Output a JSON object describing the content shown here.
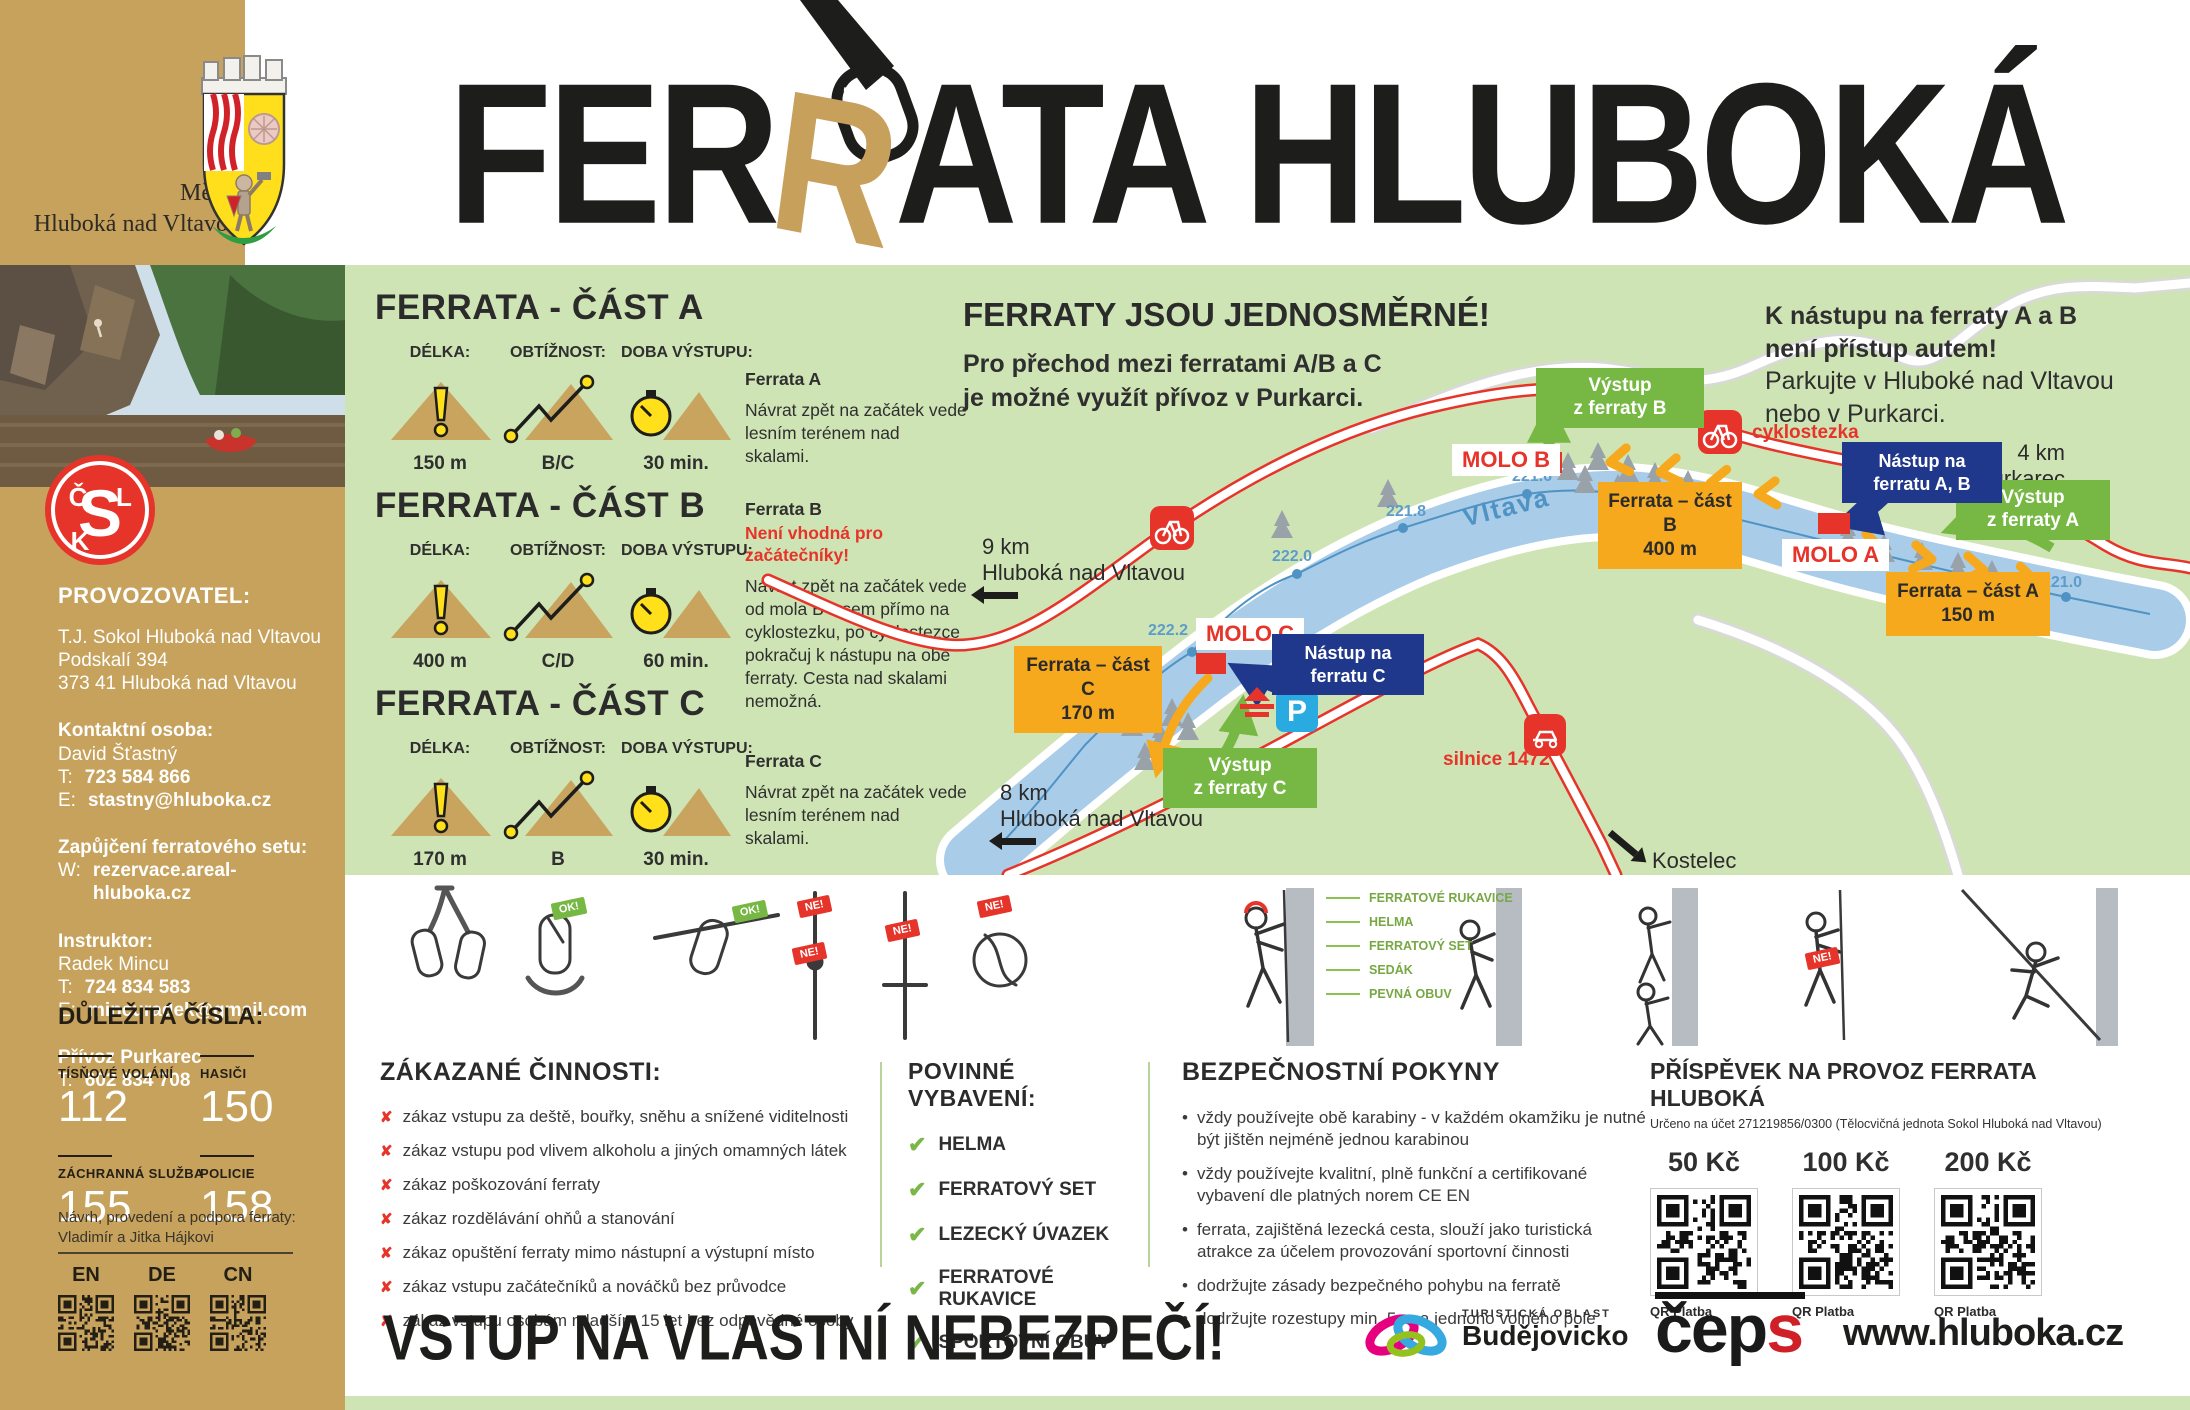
{
  "header": {
    "title_pre": "FER",
    "title_r": "R",
    "title_post": "ATA HLUBOKÁ"
  },
  "sidebar": {
    "city_line1": "Město",
    "city_line2": "Hluboká nad Vltavou",
    "provider_heading": "PROVOZOVATEL:",
    "provider_lines": [
      "T.J. Sokol Hluboká nad Vltavou",
      "Podskalí 394",
      "373 41 Hluboká nad Vltavou"
    ],
    "contact_heading": "Kontaktní osoba:",
    "contact_name": "David Šťastný",
    "phone_label": "T:",
    "email_label": "E:",
    "web_label": "W:",
    "contact_phone": "723 584 866",
    "contact_email": "stastny@hluboka.cz",
    "rental_heading": "Zapůjčení ferratového setu:",
    "rental_web": "rezervace.areal-hluboka.cz",
    "instructor_heading": "Instruktor:",
    "instructor_name": "Radek Mincu",
    "instructor_phone": "724 834 583",
    "instructor_email": "mincuradek@gmail.com",
    "ferry_heading": "Přívoz Purkarec",
    "ferry_phone": "602 834 708",
    "emergency_heading": "DŮLEŽITÁ ČÍSLA:",
    "emergency": [
      {
        "label": "TÍSŇOVÉ VOLÁNÍ",
        "number": "112"
      },
      {
        "label": "HASIČI",
        "number": "150"
      },
      {
        "label": "ZÁCHRANNÁ SLUŽBA",
        "number": "155"
      },
      {
        "label": "POLICIE",
        "number": "158"
      }
    ],
    "credits_line1": "Návrh, provedení a podpora ferraty:",
    "credits_line2": "Vladimír a Jitka Hájkovi",
    "languages": [
      "EN",
      "DE",
      "CN"
    ]
  },
  "routes": {
    "length_label": "DÉLKA:",
    "difficulty_label": "OBTÍŽNOST:",
    "time_label": "DOBA VÝSTUPU:",
    "sections": [
      {
        "title": "FERRATA - ČÁST A",
        "length": "150 m",
        "difficulty": "B/C",
        "time": "30 min.",
        "desc_title": "Ferrata A",
        "desc": "Návrat zpět na začátek vede lesním terénem nad skalami."
      },
      {
        "title": "FERRATA - ČÁST B",
        "length": "400 m",
        "difficulty": "C/D",
        "time": "60 min.",
        "desc_title": "Ferrata B",
        "warning": "Není vhodná pro začátečníky!",
        "desc": "Návrat zpět na začátek vede od mola B lesem přímo na cyklostezku, po cyklostezce pokračuj k nástupu na obě ferraty. Cesta nad skalami nemožná."
      },
      {
        "title": "FERRATA - ČÁST C",
        "length": "170 m",
        "difficulty": "B",
        "time": "30 min.",
        "desc_title": "Ferrata C",
        "desc": "Návrat zpět na začátek vede lesním terénem nad skalami."
      }
    ]
  },
  "map": {
    "heading": "FERRATY JSOU JEDNOSMĚRNÉ!",
    "sub1": "Pro přechod mezi ferratami  A/B a C",
    "sub2": "je možné využít přívoz v Purkarci.",
    "note1": "K nástupu na ferraty A a B",
    "note2": "není přístup autem!",
    "note3": "Parkujte v Hluboké nad Vltavou",
    "note4": "nebo v Purkarci.",
    "dir_purkarec_distance": "4 km",
    "dir_purkarec_place": "Purkarec",
    "dir_hluboka9_distance": "9 km",
    "dir_hluboka9_place": "Hluboká nad Vltavou",
    "dir_hluboka8_distance": "8 km",
    "dir_hluboka8_place": "Hluboká nad Vltavou",
    "dir_kostelec": "Kostelec",
    "river_name": "Vltava",
    "parking": "P",
    "cyklostezka": "cyklostezka",
    "silnice": "silnice 1472",
    "contours": [
      "221.6",
      "221.8",
      "222.0",
      "222.2",
      "222.4",
      "221.0"
    ],
    "labels": {
      "molo_a": "MOLO A",
      "molo_b": "MOLO B",
      "molo_c": "MOLO C",
      "vystup_a_l1": "Výstup",
      "vystup_a_l2": "z ferraty A",
      "vystup_b_l1": "Výstup",
      "vystup_b_l2": "z ferraty B",
      "vystup_c_l1": "Výstup",
      "vystup_c_l2": "z ferraty C",
      "nastup_ab_l1": "Nástup na",
      "nastup_ab_l2": "ferratu A, B",
      "nastup_c_l1": "Nástup na",
      "nastup_c_l2": "ferratu C",
      "ferrata_a_l1": "Ferrata – část A",
      "ferrata_a_l2": "150 m",
      "ferrata_b_l1": "Ferrata – část B",
      "ferrata_b_l2": "400 m",
      "ferrata_c_l1": "Ferrata – část C",
      "ferrata_c_l2": "170 m"
    }
  },
  "pictograms": {
    "ok_badge": "OK!",
    "no_badge": "NE!",
    "equipment_labels": [
      "FERRATOVÉ RUKAVICE",
      "HELMA",
      "FERRATOVÝ SET",
      "SEDÁK",
      "PEVNÁ OBUV"
    ]
  },
  "forbidden": {
    "heading": "ZÁKAZANÉ ČINNOSTI:",
    "items": [
      "zákaz vstupu za deště, bouřky, sněhu a snížené viditelnosti",
      "zákaz vstupu pod vlivem alkoholu a jiných omamných látek",
      "zákaz poškozování ferraty",
      "zákaz rozdělávání ohňů a stanování",
      "zákaz opuštění ferraty mimo nástupní a výstupní místo",
      "zákaz vstupu začátečníků a nováčků bez průvodce",
      "zákaz vstupu osobám mladším 15 let bez odpovědné osoby"
    ]
  },
  "required": {
    "heading": "POVINNÉ VYBAVENÍ:",
    "items": [
      "HELMA",
      "FERRATOVÝ SET",
      "LEZECKÝ ÚVAZEK",
      "FERRATOVÉ RUKAVICE",
      "SPORTOVNÍ OBUV"
    ]
  },
  "safety": {
    "heading": "BEZPEČNOSTNÍ POKYNY",
    "items": [
      "vždy používejte obě karabiny - v každém okamžiku je nutné být jištěn nejméně jednou karabinou",
      "vždy používejte kvalitní, plně funkční a certifikované vybavení dle platných norem CE EN",
      "ferrata, zajištěná lezecká cesta, slouží jako turistická atrakce za účelem provozování sportovní činnosti",
      "dodržujte zásady bezpečného pohybu na ferratě",
      "dodržujte rozestupy min. 5 m a jednoho volného pole"
    ]
  },
  "donation": {
    "heading": "PŘÍSPĚVEK NA PROVOZ FERRATA HLUBOKÁ",
    "subheading": "Určeno na účet 271219856/0300 (Tělocvičná jednota Sokol Hluboká nad Vltavou)",
    "amounts": [
      "50 Kč",
      "100 Kč",
      "200 Kč"
    ],
    "qr_label": "QR Platba"
  },
  "footer": {
    "warning": "VSTUP NA VLASTNÍ NEBEZPEČÍ!",
    "tourist_area": "TURISTICKÁ OBLAST",
    "budejovicko": "Budějovicko",
    "ceps_c": "če",
    "ceps_p": "p",
    "ceps_s": "s",
    "website": "www.hluboka.cz"
  },
  "colors": {
    "accent_gold": "#c6a25d",
    "panel_green": "#cfe4b4",
    "route_orange": "#f6a91c",
    "box_green": "#76b843",
    "box_navy": "#20388c",
    "alert_red": "#e6342a",
    "river_blue": "#a9cce9"
  }
}
